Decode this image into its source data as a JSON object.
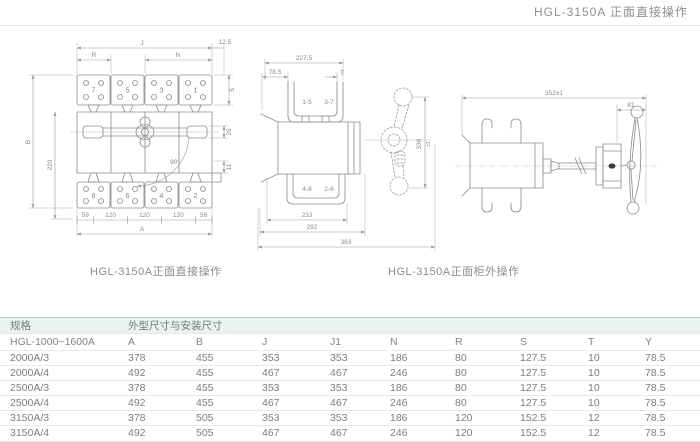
{
  "colors": {
    "table_header_bg": "#eaf3f0",
    "rule_light": "#e3ecea",
    "table_top_rule": "#b9c5c2",
    "drawing_line": "#8f8f8f",
    "text_gray": "#7d7d7d"
  },
  "header": {
    "title": "HGL-3150A 正面直接操作"
  },
  "drawings": {
    "front_direct": {
      "caption": "HGL-3150A正面直接操作",
      "terminals_top": [
        "7",
        "5",
        "3",
        "1"
      ],
      "terminals_bottom": [
        "8",
        "6",
        "4",
        "2"
      ],
      "dims": {
        "J": "J",
        "R": "R",
        "N": "N",
        "offset": "12.5",
        "S": "S",
        "B": "B",
        "h220": "220",
        "d26": "26",
        "d11": "11",
        "angle": "90°",
        "segEnd": "59",
        "segMid": "120",
        "A": "A"
      }
    },
    "front_cabinet": {
      "pairs": {
        "p15": "1-5",
        "p37": "3-7",
        "p48": "4-8",
        "p26": "2-6"
      },
      "dims": {
        "w2275": "227.5",
        "w785": "78.5",
        "T": "T",
        "h330": "330",
        "tol": "±1",
        "w233": "233",
        "w292": "292",
        "w363": "363"
      }
    },
    "side_external": {
      "caption": "HGL-3150A正面柜外操作",
      "dims": {
        "w352": "352±1",
        "w81": "81"
      }
    }
  },
  "table": {
    "spec_header": "规格",
    "dims_header": "外型尺寸与安装尺寸",
    "base_model": "HGL-1000~1600A",
    "columns": [
      "A",
      "B",
      "J",
      "J1",
      "N",
      "R",
      "S",
      "T",
      "Y"
    ],
    "rows": [
      {
        "spec": "2000A/3",
        "values": [
          "378",
          "455",
          "353",
          "353",
          "186",
          "80",
          "127.5",
          "10",
          "78.5"
        ]
      },
      {
        "spec": "2000A/4",
        "values": [
          "492",
          "455",
          "467",
          "467",
          "246",
          "80",
          "127.5",
          "10",
          "78.5"
        ]
      },
      {
        "spec": "2500A/3",
        "values": [
          "378",
          "455",
          "353",
          "353",
          "186",
          "80",
          "127.5",
          "10",
          "78.5"
        ]
      },
      {
        "spec": "2500A/4",
        "values": [
          "492",
          "455",
          "467",
          "467",
          "246",
          "80",
          "127.5",
          "10",
          "78.5"
        ]
      },
      {
        "spec": "3150A/3",
        "values": [
          "378",
          "505",
          "353",
          "353",
          "186",
          "120",
          "152.5",
          "12",
          "78.5"
        ]
      },
      {
        "spec": "3150A/4",
        "values": [
          "492",
          "505",
          "467",
          "467",
          "246",
          "120",
          "152.5",
          "12",
          "78.5"
        ]
      }
    ]
  }
}
